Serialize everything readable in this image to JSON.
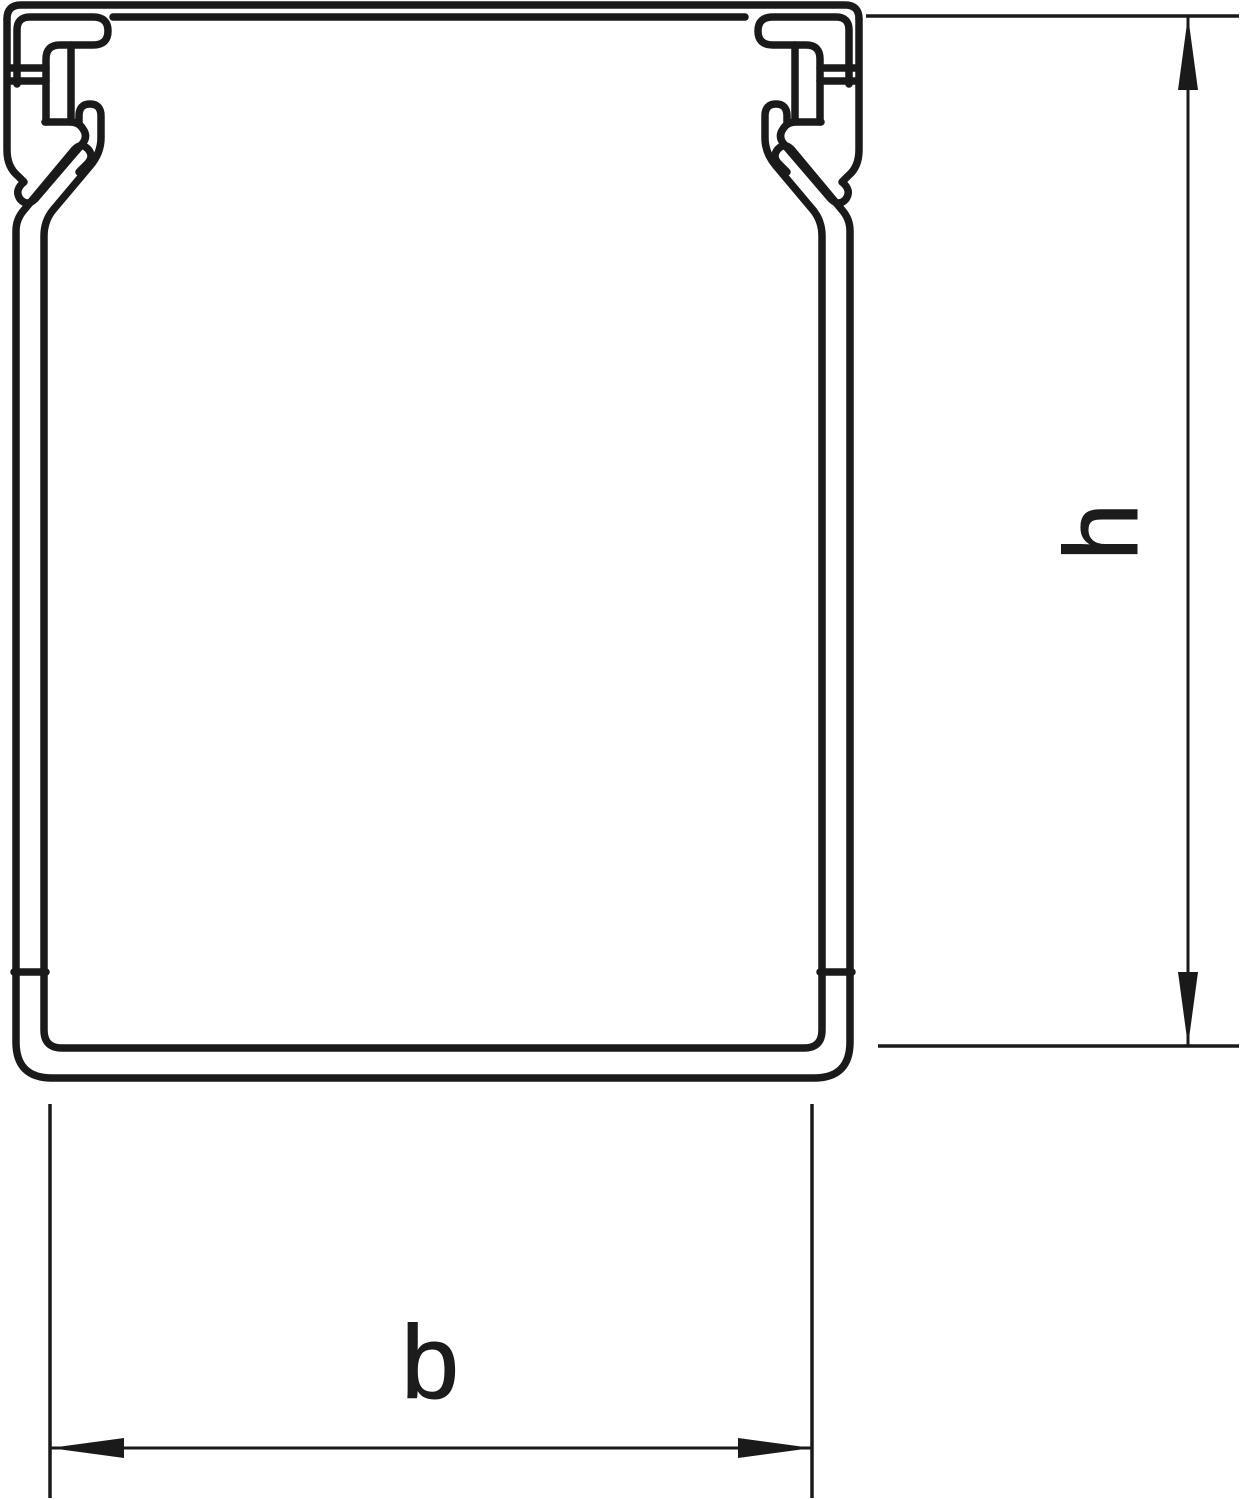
{
  "drawing": {
    "description": "Cable trunking cross-section profile",
    "dimension_labels": {
      "height": "h",
      "width": "b"
    }
  },
  "colors": {
    "line": "#1a1a1a",
    "background": "#ffffff"
  }
}
